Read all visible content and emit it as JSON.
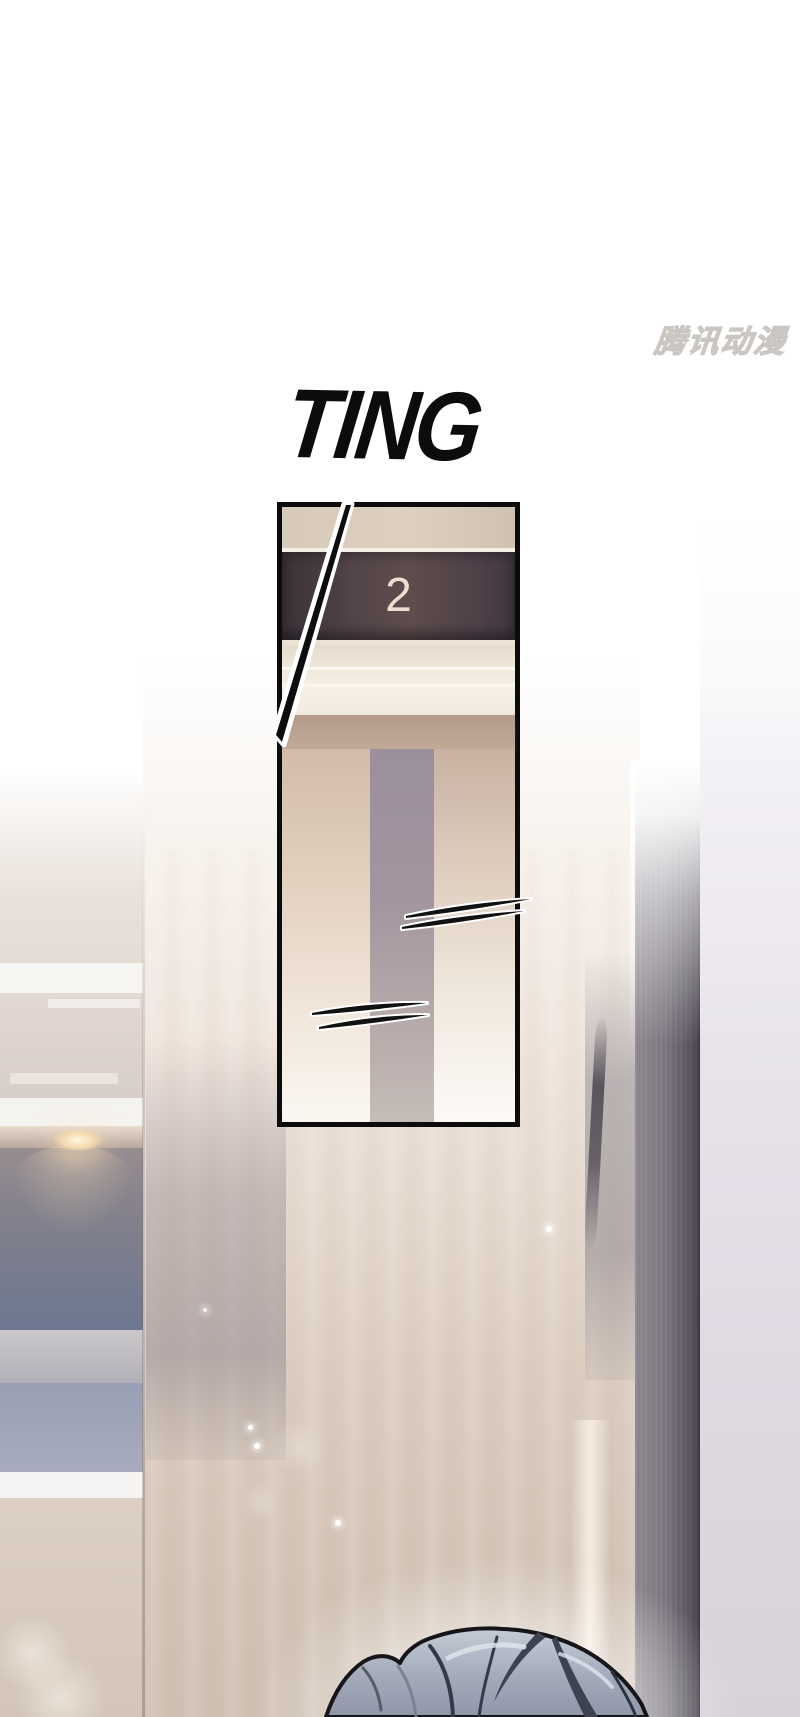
{
  "sfx": {
    "text": "TING",
    "color": "#0d0c0a"
  },
  "panel": {
    "floor_number": "2",
    "floor_number_color": "#eadfd0",
    "border_color": "#0c0c0c",
    "display_band_color": "#4e4048",
    "ceiling_color": "#f3ece0",
    "door_column_color": "#a3959f"
  },
  "watermark": {
    "text": "腾讯动漫",
    "color": "#c5c2bc"
  },
  "scene": {
    "background": "#ffffff",
    "wall_warm": "#d3c4b6",
    "wall_blue_gray": "#6d7890",
    "beam_dark": "#4c4752",
    "right_wall_lavender": "#dfd9e2",
    "downlight_glow": "#f3d9ae",
    "hair_gray_blue": "#9aa2b2"
  }
}
